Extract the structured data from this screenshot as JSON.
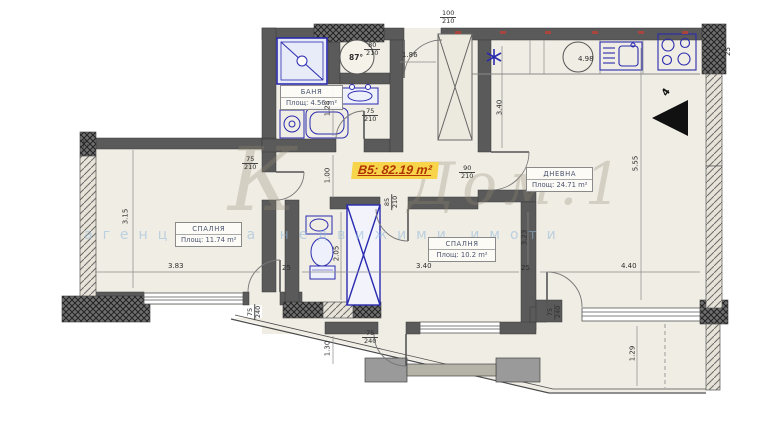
{
  "unit_label": "B5: 82.19 m²",
  "rooms": {
    "bath": {
      "name": "БАНЯ",
      "area": "Площ: 4.56 m²"
    },
    "bedroom1": {
      "name": "СПАЛНЯ",
      "area": "Площ: 11.74 m²"
    },
    "bedroom2": {
      "name": "СПАЛНЯ",
      "area": "Площ: 10.2 m²"
    },
    "living": {
      "name": "ДНЕВНА",
      "area": "Площ: 24.71 m²"
    }
  },
  "dims": {
    "bedroom1_height": "3.15",
    "bedroom1_width": "3.83",
    "bedroom2_width": "3.40",
    "bedroom2_height": "3.23",
    "living_width": "4.40",
    "living_height": "5.55",
    "hall_depth": "1.28",
    "wc_width": "1.00",
    "wc_depth": "2.05",
    "balcony_left_depth": "1.30",
    "balcony_right_depth": "1.29",
    "kitchen_run": "4.98",
    "entry_width": "1.86",
    "hall_height": "3.40",
    "wall_thickness": "25"
  },
  "doors": {
    "entrance": {
      "w": "100",
      "h": "210"
    },
    "wc": {
      "w": "80",
      "h": "210"
    },
    "bath": {
      "w": "75",
      "h": "210"
    },
    "bedroom1": {
      "w": "75",
      "h": "210"
    },
    "bedroom2": {
      "w": "85",
      "h": "210"
    },
    "living": {
      "w": "90",
      "h": "210"
    },
    "balcony_left": {
      "w": "75",
      "h": "240"
    },
    "balcony_mid": {
      "w": "75",
      "h": "240"
    },
    "balcony_right": {
      "w": "75",
      "h": "240"
    }
  },
  "annotations": {
    "boiler_label": "87°",
    "north_mark": "4"
  },
  "watermark": {
    "initial": "К",
    "script": "Дом.1",
    "subtitle": "агенция за недвижими имоти"
  },
  "colors": {
    "wall": "#5a5a5a",
    "floor": "#f0ede4",
    "fixture": "#2a2ab0",
    "highlight_bg": "#f7d44a",
    "highlight_text": "#b13400",
    "watermark": "#a59a88",
    "watermark_blue": "#8fb8dc"
  }
}
